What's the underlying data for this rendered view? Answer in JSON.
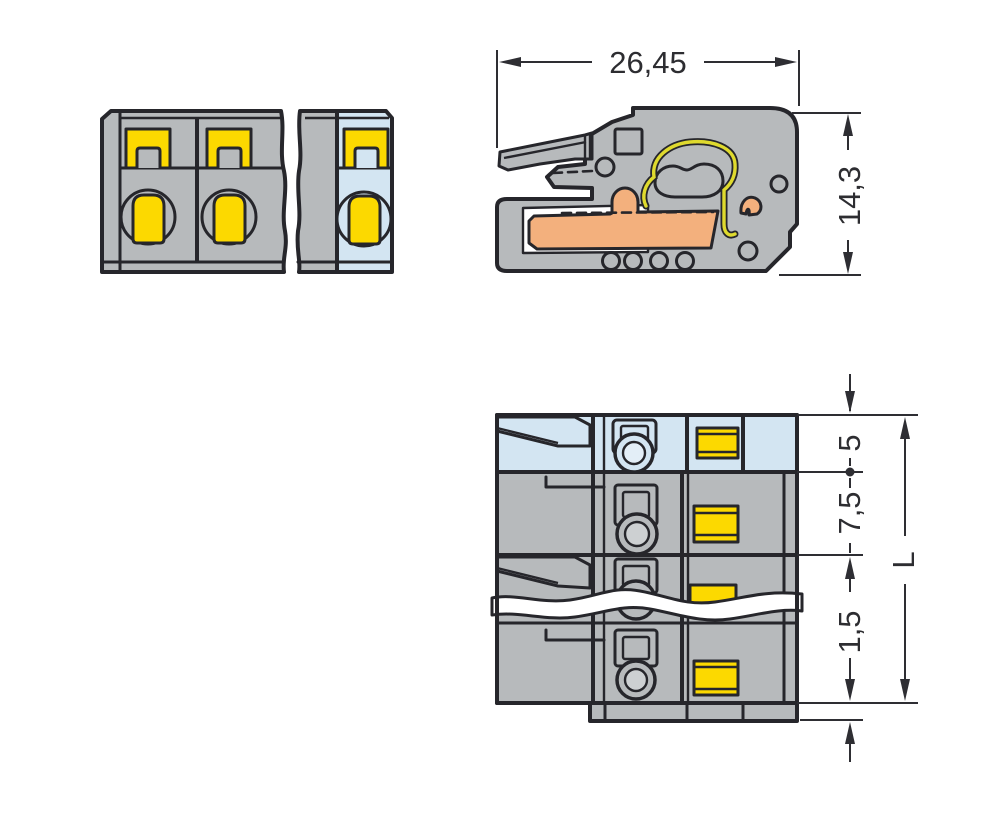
{
  "drawing": {
    "type": "connector-technical-drawing",
    "colors": {
      "background": "#ffffff",
      "body_gray": "#b7babc",
      "highlight_blue": "#d3e5f2",
      "clamp_yellow": "#fcd900",
      "busbar_orange": "#f3b07d",
      "spring_yellow": "#dfda2e",
      "outline": "#26262b",
      "dimension": "#2e2e33"
    },
    "views": {
      "side": {
        "dim_width": "26,45",
        "dim_height": "14,3"
      },
      "bottom": {
        "dim_first_pole": "5",
        "dim_pitch": "7,5",
        "dim_foot": "1,5",
        "dim_total_length": "L"
      }
    }
  }
}
